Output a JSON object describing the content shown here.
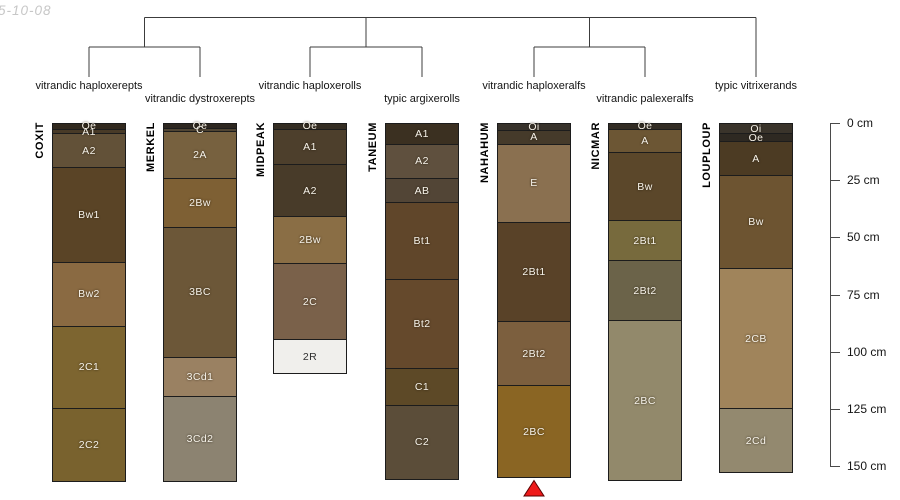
{
  "figure": {
    "date_label": "5-10-08"
  },
  "chart_data": {
    "type": "bar",
    "subtype": "soil-profile-depth-columns-with-dendrogram",
    "title": "",
    "ylabel": "depth",
    "unit": "cm",
    "ylim_cm": [
      0,
      157
    ],
    "depth_axis": {
      "ticks_cm": [
        0,
        25,
        50,
        75,
        100,
        125,
        150
      ],
      "tick_labels": [
        "0 cm",
        "25 cm",
        "50 cm",
        "75 cm",
        "100 cm",
        "125 cm",
        "150 cm"
      ]
    },
    "dendrogram": {
      "clusters": [
        [
          0,
          1
        ],
        [
          2,
          3
        ],
        [
          4,
          5
        ],
        [
          6
        ]
      ],
      "line_color": "#3c3c3c"
    },
    "marker": {
      "shape": "triangle-up",
      "color": "#ee1a1a",
      "outline": "#5a0000",
      "under_profile": "NAHAHUM"
    },
    "profiles": [
      {
        "name": "COXIT",
        "taxon": "vitrandic haploxerepts",
        "taxon_row": 1,
        "horizons": [
          {
            "label": "Oe",
            "top_cm": 0,
            "bottom_cm": 3,
            "color": "#31291e"
          },
          {
            "label": "A1",
            "top_cm": 3,
            "bottom_cm": 5,
            "color": "#483a27"
          },
          {
            "label": "A2",
            "top_cm": 5,
            "bottom_cm": 19.5,
            "color": "#625138"
          },
          {
            "label": "Bw1",
            "top_cm": 19.5,
            "bottom_cm": 61,
            "color": "#5a4426"
          },
          {
            "label": "Bw2",
            "top_cm": 61,
            "bottom_cm": 89,
            "color": "#8a6a42"
          },
          {
            "label": "2C1",
            "top_cm": 89,
            "bottom_cm": 125,
            "color": "#7d6530"
          },
          {
            "label": "2C2",
            "top_cm": 125,
            "bottom_cm": 157,
            "color": "#79622e"
          }
        ]
      },
      {
        "name": "MERKEL",
        "taxon": "vitrandic dystroxerepts",
        "taxon_row": 2,
        "horizons": [
          {
            "label": "Oe",
            "top_cm": 0,
            "bottom_cm": 2.5,
            "color": "#2d2720"
          },
          {
            "label": "C",
            "top_cm": 2.5,
            "bottom_cm": 4,
            "color": "#4f4433"
          },
          {
            "label": "2A",
            "top_cm": 4,
            "bottom_cm": 24.5,
            "color": "#77613f"
          },
          {
            "label": "2Bw",
            "top_cm": 24.5,
            "bottom_cm": 46,
            "color": "#7e6034"
          },
          {
            "label": "3BC",
            "top_cm": 46,
            "bottom_cm": 102.5,
            "color": "#6c5738"
          },
          {
            "label": "3Cd1",
            "top_cm": 102.5,
            "bottom_cm": 119.5,
            "color": "#9a8162"
          },
          {
            "label": "3Cd2",
            "top_cm": 119.5,
            "bottom_cm": 157,
            "color": "#8c8371"
          }
        ]
      },
      {
        "name": "MIDPEAK",
        "taxon": "vitrandic haploxerolls",
        "taxon_row": 1,
        "horizons": [
          {
            "label": "Oe",
            "top_cm": 0,
            "bottom_cm": 3,
            "color": "#342d23"
          },
          {
            "label": "A1",
            "top_cm": 3,
            "bottom_cm": 18.5,
            "color": "#4d3f2c"
          },
          {
            "label": "A2",
            "top_cm": 18.5,
            "bottom_cm": 41,
            "color": "#483b29"
          },
          {
            "label": "2Bw",
            "top_cm": 41,
            "bottom_cm": 61.5,
            "color": "#8a6e45"
          },
          {
            "label": "2C",
            "top_cm": 61.5,
            "bottom_cm": 95,
            "color": "#7a614a"
          },
          {
            "label": "2R",
            "top_cm": 95,
            "bottom_cm": 109.5,
            "color": "#f0efec",
            "text_color": "#2f2f2f"
          }
        ]
      },
      {
        "name": "TANEUM",
        "taxon": "typic argixerolls",
        "taxon_row": 2,
        "horizons": [
          {
            "label": "A1",
            "top_cm": 0,
            "bottom_cm": 9.5,
            "color": "#3b3021"
          },
          {
            "label": "A2",
            "top_cm": 9.5,
            "bottom_cm": 24.5,
            "color": "#5f503e"
          },
          {
            "label": "AB",
            "top_cm": 24.5,
            "bottom_cm": 35,
            "color": "#524536"
          },
          {
            "label": "Bt1",
            "top_cm": 35,
            "bottom_cm": 68.5,
            "color": "#60462a"
          },
          {
            "label": "Bt2",
            "top_cm": 68.5,
            "bottom_cm": 107.5,
            "color": "#65492c"
          },
          {
            "label": "C1",
            "top_cm": 107.5,
            "bottom_cm": 123.5,
            "color": "#5d4927"
          },
          {
            "label": "C2",
            "top_cm": 123.5,
            "bottom_cm": 156,
            "color": "#5b4d39"
          }
        ]
      },
      {
        "name": "NAHAHUM",
        "taxon": "vitrandic haploxeralfs",
        "taxon_row": 1,
        "horizons": [
          {
            "label": "Oi",
            "top_cm": 0,
            "bottom_cm": 3.5,
            "color": "#37322b"
          },
          {
            "label": "A",
            "top_cm": 3.5,
            "bottom_cm": 9.5,
            "color": "#453a2a"
          },
          {
            "label": "E",
            "top_cm": 9.5,
            "bottom_cm": 43.5,
            "color": "#8a7050"
          },
          {
            "label": "2Bt1",
            "top_cm": 43.5,
            "bottom_cm": 87,
            "color": "#594228"
          },
          {
            "label": "2Bt2",
            "top_cm": 87,
            "bottom_cm": 115,
            "color": "#7c5f3e"
          },
          {
            "label": "2BC",
            "top_cm": 115,
            "bottom_cm": 155,
            "color": "#8a6523"
          }
        ]
      },
      {
        "name": "NICMAR",
        "taxon": "vitrandic palexeralfs",
        "taxon_row": 2,
        "horizons": [
          {
            "label": "Oe",
            "top_cm": 0,
            "bottom_cm": 3,
            "color": "#322c24"
          },
          {
            "label": "A",
            "top_cm": 3,
            "bottom_cm": 13,
            "color": "#6c5634"
          },
          {
            "label": "Bw",
            "top_cm": 13,
            "bottom_cm": 43,
            "color": "#5b472a"
          },
          {
            "label": "2Bt1",
            "top_cm": 43,
            "bottom_cm": 60.5,
            "color": "#776a3d"
          },
          {
            "label": "2Bt2",
            "top_cm": 60.5,
            "bottom_cm": 86.5,
            "color": "#6b6349"
          },
          {
            "label": "2BC",
            "top_cm": 86.5,
            "bottom_cm": 156.5,
            "color": "#92896b"
          }
        ]
      },
      {
        "name": "LOUPLOUP",
        "taxon": "typic vitrixerands",
        "taxon_row": 1,
        "horizons": [
          {
            "label": "Oi",
            "top_cm": 0,
            "bottom_cm": 5,
            "color": "#3a342b"
          },
          {
            "label": "Oe",
            "top_cm": 5,
            "bottom_cm": 8.5,
            "color": "#2e2922"
          },
          {
            "label": "A",
            "top_cm": 8.5,
            "bottom_cm": 23,
            "color": "#4c3b23"
          },
          {
            "label": "Bw",
            "top_cm": 23,
            "bottom_cm": 64,
            "color": "#6d5431"
          },
          {
            "label": "2CB",
            "top_cm": 64,
            "bottom_cm": 125,
            "color": "#a0845b"
          },
          {
            "label": "2Cd",
            "top_cm": 125,
            "bottom_cm": 153,
            "color": "#93896f"
          }
        ]
      }
    ]
  }
}
